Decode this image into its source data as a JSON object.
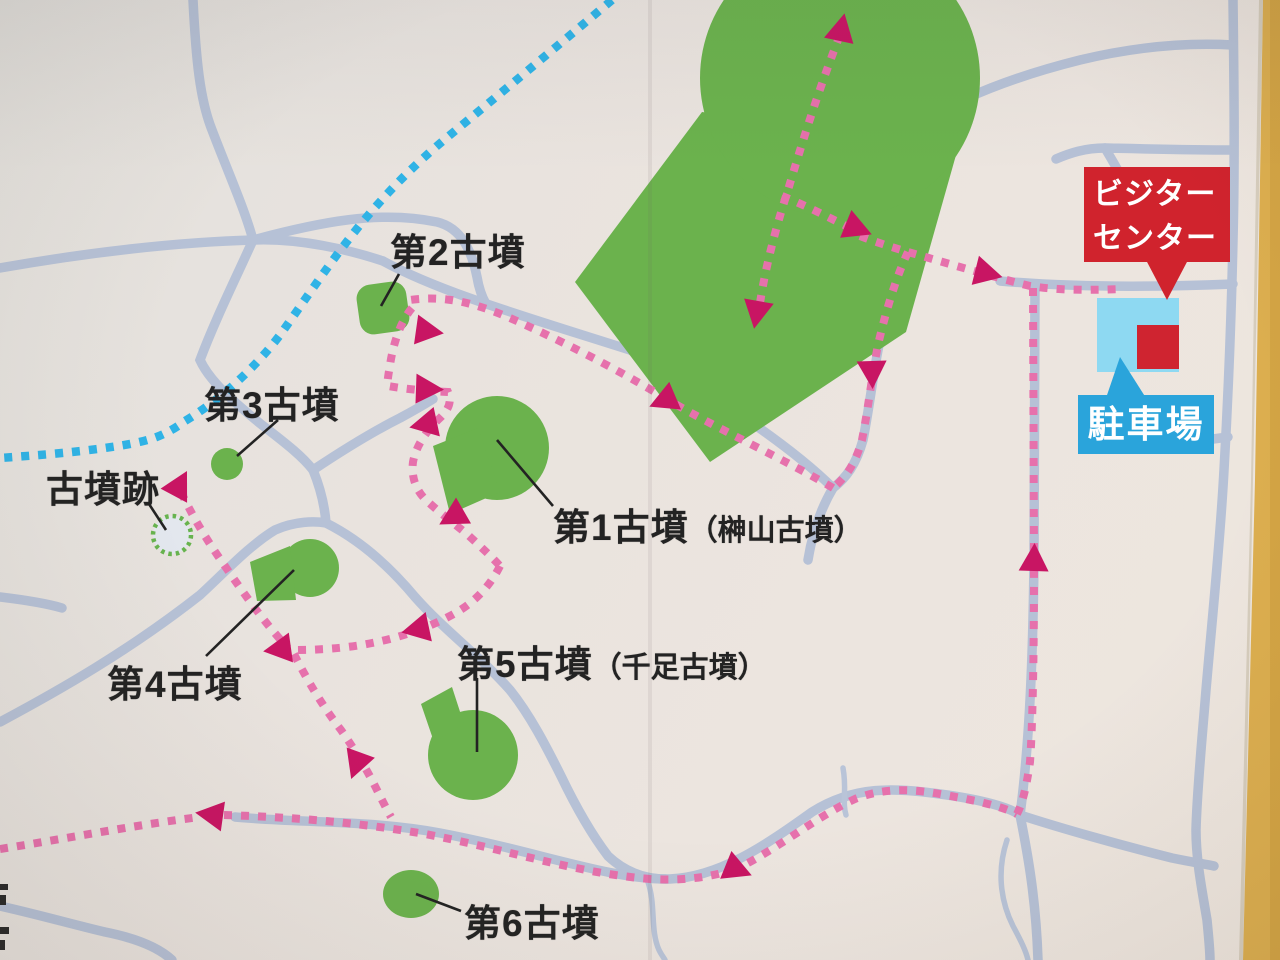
{
  "map": {
    "title_context": "kofun walking-course guide map (photographed signboard)",
    "labels": {
      "kofun1": {
        "name": "第1古墳",
        "alias": "（榊山古墳）"
      },
      "kofun2": {
        "name": "第2古墳"
      },
      "kofun3": {
        "name": "第3古墳"
      },
      "kofun4": {
        "name": "第4古墳"
      },
      "kofun5": {
        "name": "第5古墳",
        "alias": "（千足古墳）"
      },
      "kofun6": {
        "name": "第6古墳"
      },
      "kofun_ato": {
        "name": "古墳跡"
      }
    },
    "signs": {
      "visitor_center": {
        "line1": "ビジター",
        "line2": "センター",
        "bg": "#d0232d"
      },
      "parking": {
        "label": "駐車場",
        "bg": "#2aa4db"
      }
    },
    "colors": {
      "background": "#e9e3de",
      "road": "#b6c1d6",
      "mound_green": "#6bb24d",
      "route_pink_dots": "#e671ac",
      "route_arrow_magenta": "#c81563",
      "route_blue_dots": "#2fb3e6",
      "wall_yellow": "#dcae4f",
      "ruin_ring_green": "#67b34e",
      "parking_lot_blue": "#8ed9f2",
      "building_red": "#cf2430"
    }
  }
}
